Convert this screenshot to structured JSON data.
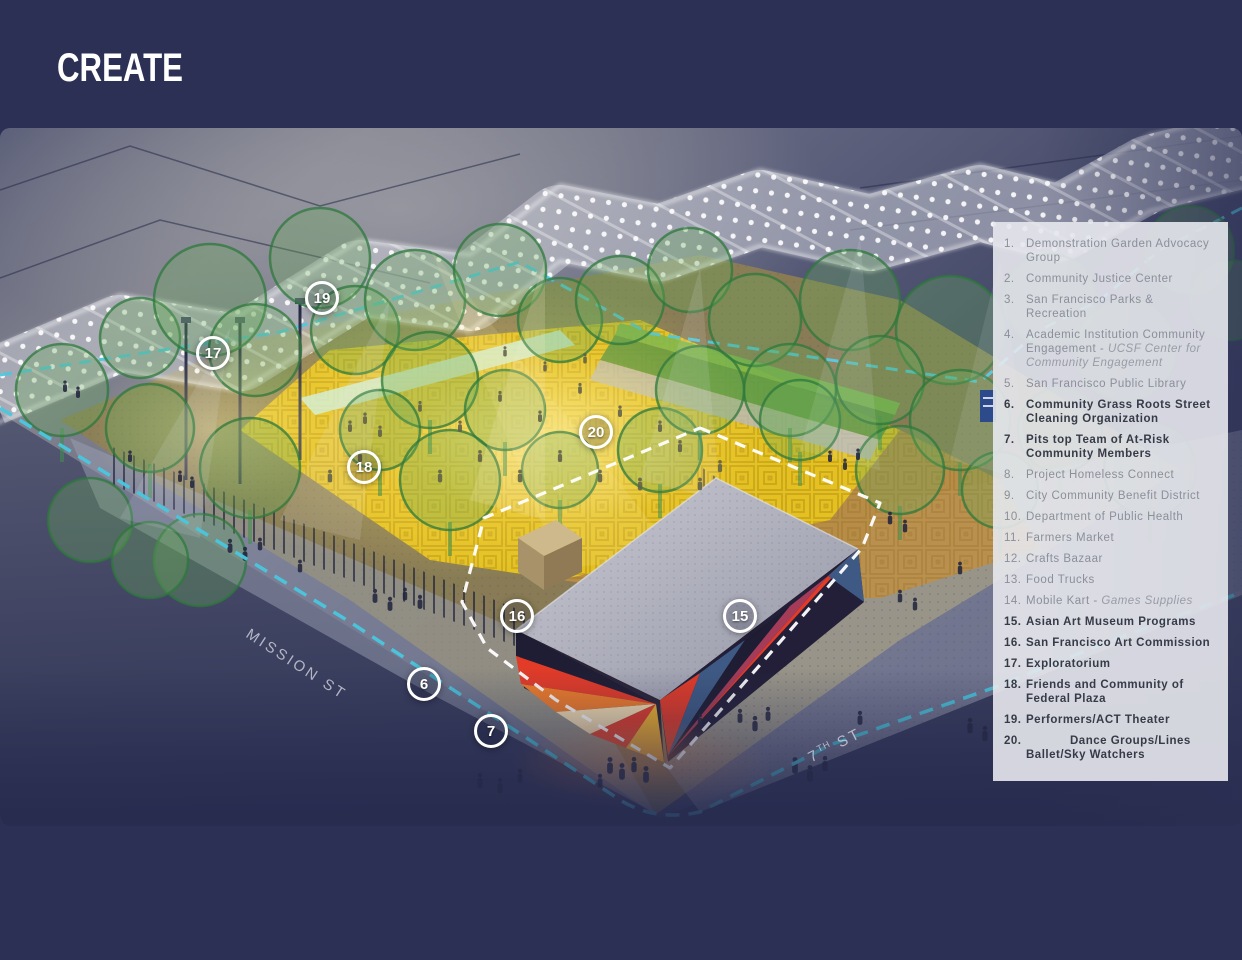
{
  "title": "CREATE",
  "streets": {
    "mission": "MISSION ST",
    "seventh_num": "7",
    "seventh_sup": "TH",
    "seventh_rest": " ST"
  },
  "colors": {
    "page_background": "#2b3054",
    "legend_panel": "rgba(231,232,237,0.90)",
    "legend_text_muted": "#8b8f9a",
    "legend_text_bold": "#363b47",
    "cyan_dashed_line": "#49c7de",
    "court_yellow": "#e9c51f",
    "mural_red": "#e23b28",
    "mural_orange": "#f07c2a",
    "tree_green": "#2f7a3f",
    "marker_ring": "#ffffff"
  },
  "legend": {
    "items": [
      {
        "n": "1.",
        "t": "Demonstration Garden Advocacy Group",
        "bold": false
      },
      {
        "n": "2.",
        "t": "Community Justice Center",
        "bold": false
      },
      {
        "n": "3.",
        "t": "San Francisco Parks & Recreation",
        "bold": false
      },
      {
        "n": "4.",
        "t": "Academic Institution Community Engagement - ",
        "italic": "UCSF Center for Community Engagement",
        "bold": false
      },
      {
        "n": "5.",
        "t": "San Francisco Public Library",
        "bold": false
      },
      {
        "n": "6.",
        "t": "Community Grass Roots Street Cleaning Organization",
        "bold": true
      },
      {
        "n": "7.",
        "t": "Pits top Team of At-Risk Community Members",
        "bold": true
      },
      {
        "n": "8.",
        "t": "Project Homeless Connect",
        "bold": false
      },
      {
        "n": "9.",
        "t": "City Community Benefit District",
        "bold": false
      },
      {
        "n": "10.",
        "t": "Department of Public Health",
        "bold": false
      },
      {
        "n": "11.",
        "t": "Farmers Market",
        "bold": false
      },
      {
        "n": "12.",
        "t": "Crafts Bazaar",
        "bold": false
      },
      {
        "n": "13.",
        "t": "Food Trucks",
        "bold": false
      },
      {
        "n": "14.",
        "t": "Mobile Kart - ",
        "italic": "Games Supplies",
        "bold": false
      },
      {
        "n": "15.",
        "t": "Asian Art Museum Programs",
        "bold": true
      },
      {
        "n": "16.",
        "t": "San Francisco Art Commission",
        "bold": true
      },
      {
        "n": "17.",
        "t": "Exploratorium",
        "bold": true
      },
      {
        "n": "18.",
        "t": "Friends and Community of Federal Plaza",
        "bold": true
      },
      {
        "n": "19.",
        "t": "Performers/ACT Theater",
        "bold": true
      },
      {
        "n": "20.",
        "t": "Dance Groups/Lines Ballet/Sky Watchers",
        "bold": true,
        "indent": true
      }
    ]
  },
  "markers": [
    {
      "label": "19",
      "x": 322,
      "y": 170
    },
    {
      "label": "17",
      "x": 213,
      "y": 225
    },
    {
      "label": "20",
      "x": 596,
      "y": 304
    },
    {
      "label": "18",
      "x": 364,
      "y": 339
    },
    {
      "label": "16",
      "x": 517,
      "y": 488
    },
    {
      "label": "15",
      "x": 740,
      "y": 488
    },
    {
      "label": "6",
      "x": 424,
      "y": 556
    },
    {
      "label": "7",
      "x": 491,
      "y": 603
    }
  ]
}
